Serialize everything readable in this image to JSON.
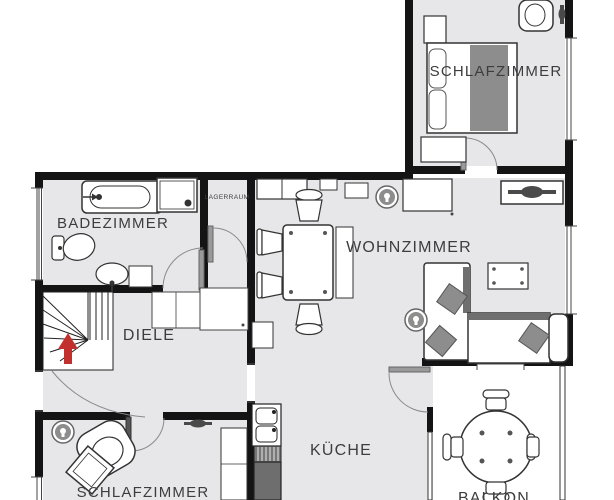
{
  "title": "Apartment floor plan",
  "rooms": {
    "badezimmer": {
      "label": "BADEZIMMER"
    },
    "lagerraum": {
      "label": "LAGERRAUM"
    },
    "wohnzimmer": {
      "label": "WOHNZIMMER"
    },
    "diele": {
      "label": "DIELE"
    },
    "kueche": {
      "label": "KÜCHE"
    },
    "schlafzimmer_top": {
      "label": "SCHLAFZIMMER"
    },
    "schlafzimmer_bottom": {
      "label": "SCHLAFZIMMER"
    },
    "balkon": {
      "label": "BALKON"
    }
  },
  "icons": [
    "lamp-icon",
    "stairs-up-arrow-icon"
  ],
  "colors": {
    "floor": "#e7e7e9",
    "wall": "#141414",
    "furniture_gray": "#8d8d8d",
    "counter_gray": "#6e6e6e",
    "arrow_red": "#c2302e",
    "label_text": "#3d3d3d"
  }
}
